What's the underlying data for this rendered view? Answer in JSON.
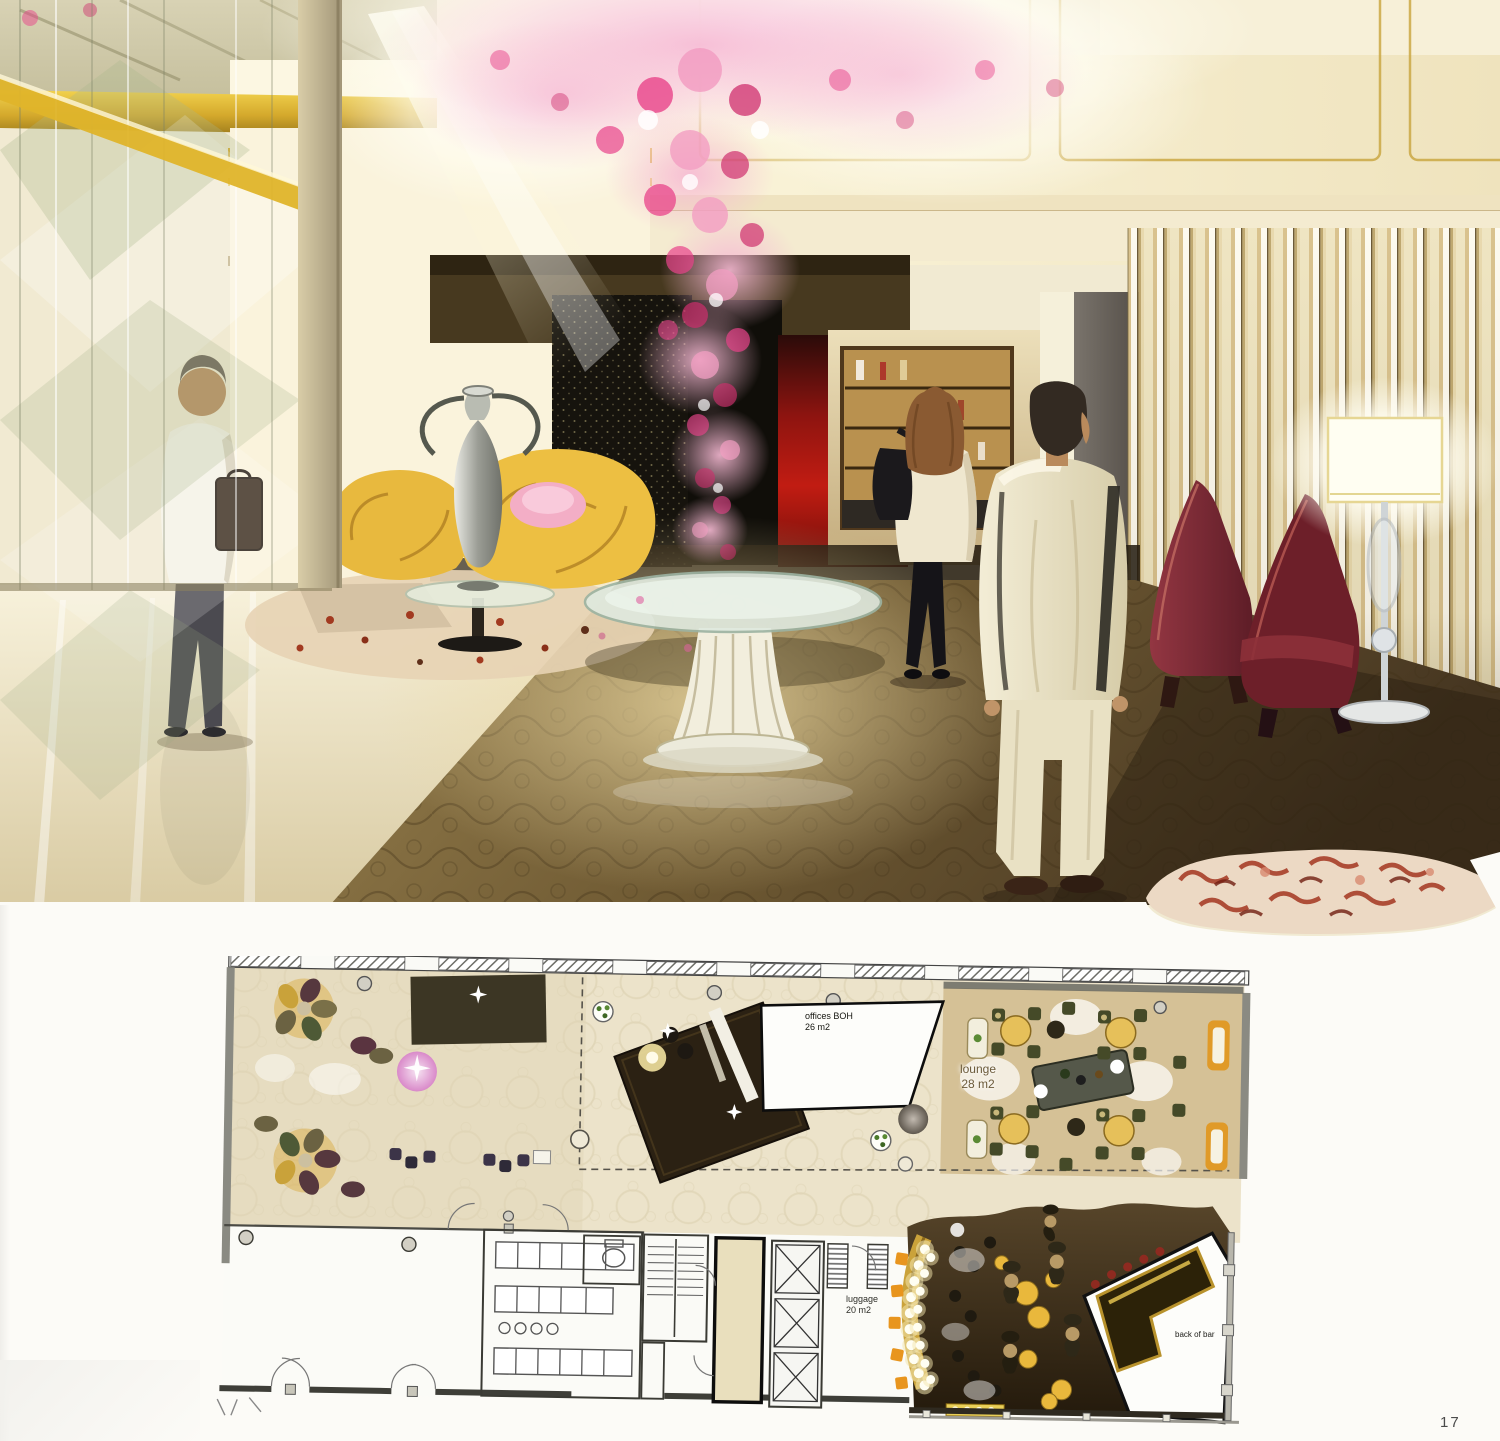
{
  "page": {
    "number": "17"
  },
  "rendering": {
    "colors": {
      "paper": "#fcfbf7",
      "gold_trim": "#d8ae2e",
      "cream_wall": "#f1e8cf",
      "carpet_brown": "#6b5836",
      "flower_pink": "#e0437f",
      "feature_red": "#b11a12",
      "chair_burgundy": "#7c2631",
      "chair_gold": "#e8b93e"
    }
  },
  "floor_plan": {
    "labels": {
      "offices": {
        "line1": "offices BOH",
        "line2": "26 m2"
      },
      "lounge": {
        "line1": "lounge",
        "line2": "28 m2"
      },
      "luggage": {
        "line1": "luggage",
        "line2": "20 m2"
      },
      "back_of_bar": {
        "line1": "back of bar"
      }
    }
  }
}
